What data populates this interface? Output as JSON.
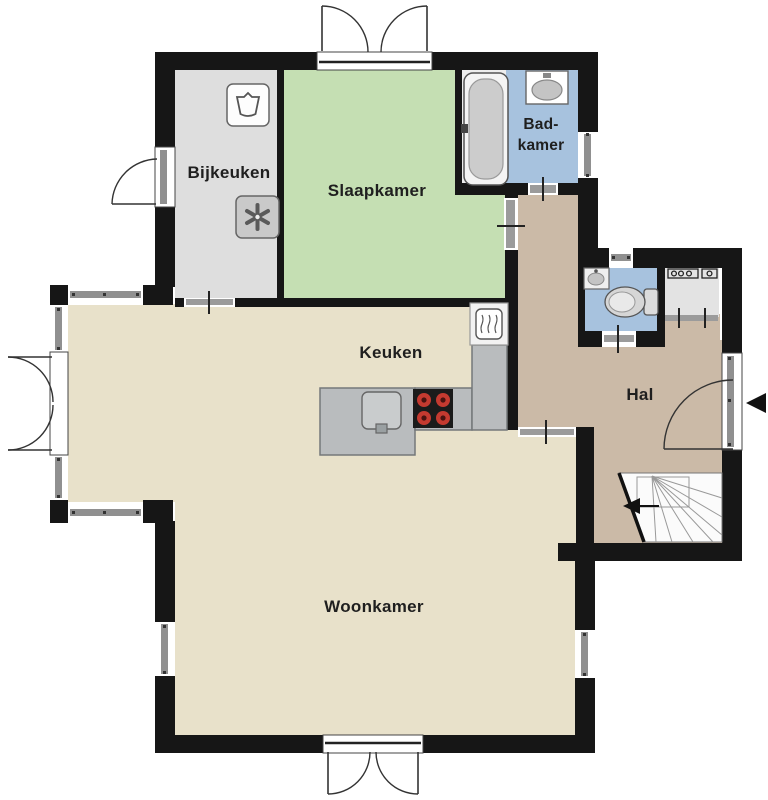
{
  "rooms": {
    "bijkeuken": {
      "label": "Bijkeuken"
    },
    "slaapkamer": {
      "label": "Slaapkamer"
    },
    "badkamer": {
      "line1": "Bad-",
      "line2": "kamer"
    },
    "keuken": {
      "label": "Keuken"
    },
    "hal": {
      "label": "Hal"
    },
    "woonkamer": {
      "label": "Woonkamer"
    }
  },
  "icons": {
    "washing_machine": "basin-glyph",
    "ventilation_fan": "asterisk-fan",
    "bathtub": "oval-tub",
    "wash_basin": "oval-sink",
    "toilet": "bowl-and-cistern",
    "corner_sink": "small-oval-sink",
    "meter_cupboard": "electric-meter-symbols",
    "dishwasher": "wavy-lines-box",
    "kitchen_sink": "rounded-square-sink",
    "stove": "four-red-burners",
    "stairs": "winder-stairs-with-arrow",
    "entrance_arrow": "solid-left-triangle"
  },
  "colors": {
    "outside": "#ffffff",
    "wall": "#161616",
    "bijkeuken_floor": "#dedede",
    "slaapkamer_floor": "#c5dfb3",
    "badkamer_floor": "#a7c2de",
    "tub_niche_floor": "#ededed",
    "hal_floor": "#cbbaa7",
    "woonkamer_floor": "#e8e1ca",
    "closet_floor": "#e3e3e3",
    "counter": "#b9bcbe",
    "stove": "#1b1b1b",
    "burner": "#c43a30",
    "stairs": "#fbfbfb",
    "window_bar": "#909090",
    "door_bar": "#9b9b9b"
  }
}
